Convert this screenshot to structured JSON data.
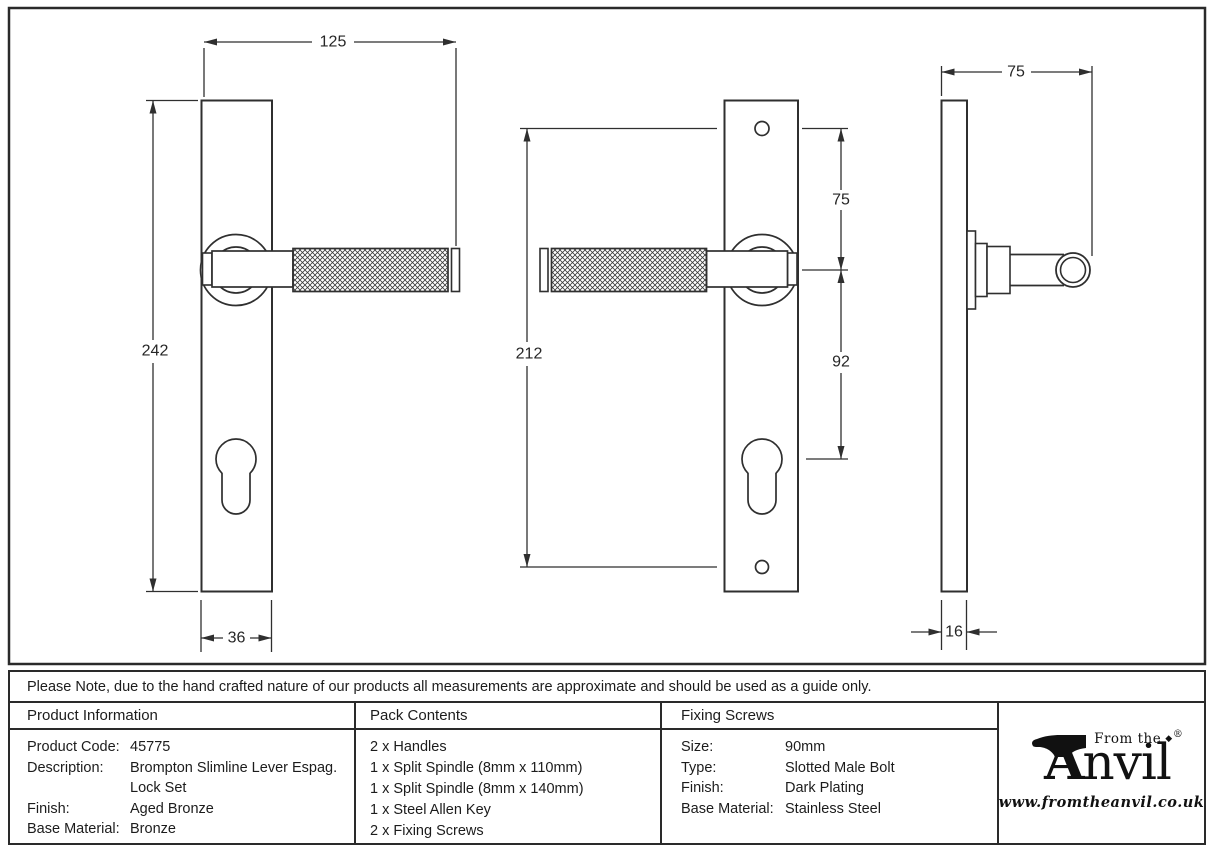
{
  "note": "Please Note, due to the hand crafted nature of our products all measurements are approximate and should be used as a guide only.",
  "views": {
    "front_a": {
      "overall_width": "125",
      "plate_height": "242",
      "plate_width": "36"
    },
    "front_b": {
      "screw_centres": "212",
      "top_to_handle": "75",
      "handle_to_cylinder": "92"
    },
    "side": {
      "projection": "75",
      "plate_thickness": "16"
    }
  },
  "table": {
    "product_information": {
      "title": "Product Information",
      "rows": [
        {
          "label": "Product Code:",
          "value": "45775"
        },
        {
          "label": "Description:",
          "value": "Brompton Slimline Lever Espag.",
          "value2": "Lock Set"
        },
        {
          "label": "Finish:",
          "value": "Aged Bronze"
        },
        {
          "label": "Base Material:",
          "value": "Bronze"
        }
      ]
    },
    "pack_contents": {
      "title": "Pack Contents",
      "items": [
        "2 x Handles",
        "1 x Split Spindle (8mm x 110mm)",
        "1 x Split Spindle (8mm x 140mm)",
        "1 x Steel Allen Key",
        "2 x Fixing Screws"
      ]
    },
    "fixing_screws": {
      "title": "Fixing Screws",
      "rows": [
        {
          "label": "Size:",
          "value": "90mm"
        },
        {
          "label": "Type:",
          "value": "Slotted Male Bolt"
        },
        {
          "label": "Finish:",
          "value": "Dark Plating"
        },
        {
          "label": "Base Material:",
          "value": "Stainless Steel"
        }
      ]
    }
  },
  "brand": {
    "prefix": "From the",
    "wordmark_a": "A",
    "wordmark_rest": "nvil",
    "diamond": "◆",
    "registered": "®",
    "website": "www.fromtheanvil.co.uk",
    "color": "#111111"
  }
}
